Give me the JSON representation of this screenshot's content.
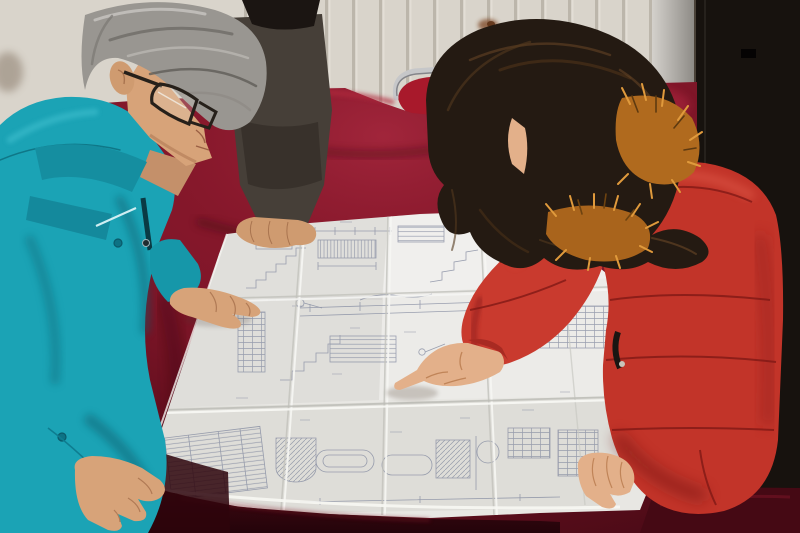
{
  "colors": {
    "wall": "#d9d4cb",
    "wallGroove": "#b7b1a6",
    "lightStrip": "#b5b2ae",
    "door": "#17120e",
    "doorSeam": "#2c2620",
    "chrome": "#c6c7c9",
    "chairRed": "#a8192b",
    "velvet": "#7c1527",
    "velvetDark": "#3a0710",
    "velvetHi": "#a82338",
    "paper": "#e8e7e3",
    "ink": "#8a90a4",
    "tealJacket": "#1ba3b5",
    "tealDark": "#0c6575",
    "darkJacket": "#463f38",
    "skinMan": "#d7a379",
    "skinWoman": "#e3b08a",
    "hairGray": "#999691",
    "hairDark": "#241a12",
    "coatRed": "#c23429",
    "coatRedDark": "#8e1f1a",
    "fur": "#b06a1e",
    "furLight": "#e09a3c",
    "rustStain": "#7c4520"
  }
}
